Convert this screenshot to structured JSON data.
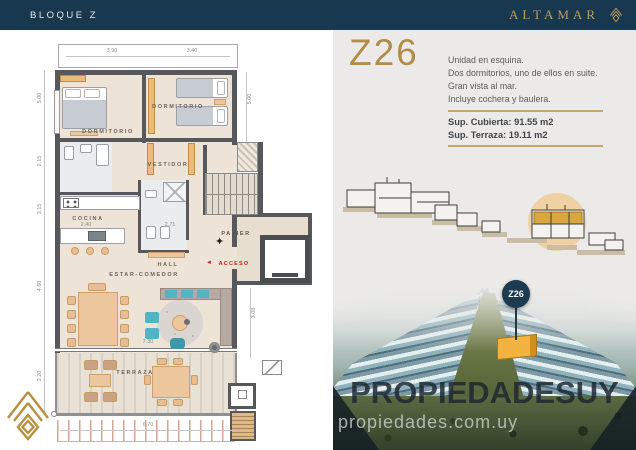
{
  "header": {
    "block_label": "BLOQUE Z",
    "brand": "ALTAMAR"
  },
  "unit": {
    "code": "Z26",
    "description": [
      "Unidad en esquina.",
      "Dos dormitorios, uno de ellos en suite.",
      "Gran vista al mar.",
      "Incluye cochera y baulera."
    ],
    "surface_covered": "Sup. Cubierta: 91.55 m2",
    "surface_terrace": "Sup. Terraza: 19.11 m2",
    "pin_label": "Z26"
  },
  "watermark": {
    "primary": "PROPIEDADESUY",
    "secondary": "propiedades.com.uy"
  },
  "floor_plan": {
    "rooms": {
      "bedroom_main": "DORMITORIO",
      "bedroom_second": "DORMITORIO",
      "dressing": "VESTIDOR",
      "kitchen": "COCINA",
      "hall": "HALL",
      "living_dining": "ESTAR-COMEDOR",
      "terrace": "TERRAZA",
      "landing": "PALIER",
      "access": "ACCESO",
      "access_arrow": "◄",
      "north_symbol": "✦"
    },
    "dimensions": {
      "top_left": "3.90",
      "top_right": "3.40",
      "left_bedroom": "5.00",
      "left_bath": "2.15",
      "left_kitchen": "3.15",
      "left_living": "4.60",
      "left_terrace": "2.20",
      "right_bedroom": "5.00",
      "right_living": "3.08",
      "kitchen_width": "2.40",
      "bath_width": "2.71",
      "living_width": "7.30",
      "terrace_width": "6.70"
    }
  },
  "colors": {
    "navy": "#17384e",
    "gold": "#b28c49",
    "accent_red": "#cb1f1c",
    "highlight_amber": "#f2b340",
    "panel_gray": "#ebeae8",
    "plan_floor": "#ede3d6"
  }
}
